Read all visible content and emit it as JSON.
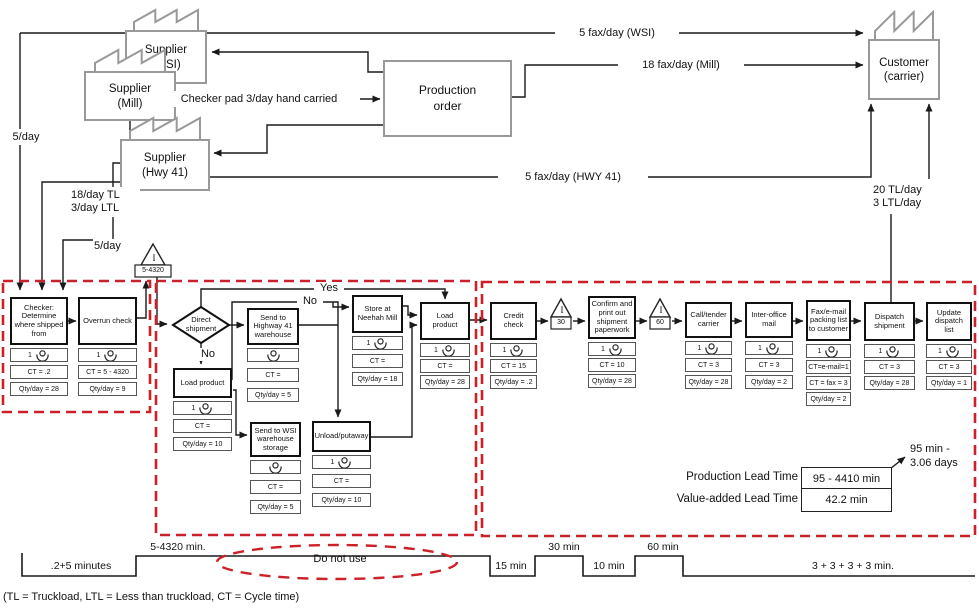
{
  "colors": {
    "line": "#1a1a1a",
    "factory_gray": "#999999",
    "dashed_red": "#cc2128"
  },
  "entities": {
    "supplier_wsi": "Supplier\n(WSI)",
    "supplier_mill": "Supplier\n(Mill)",
    "supplier_hwy41": "Supplier\n(Hwy 41)",
    "customer": "Customer\n(carrier)",
    "production_order": "Production\norder"
  },
  "decision": {
    "label": "Direct\nshipment"
  },
  "inventories": [
    {
      "id": "inv-main",
      "symbol": "I",
      "value": "5-4320"
    },
    {
      "id": "inv-30",
      "symbol": "I",
      "value": "30"
    },
    {
      "id": "inv-60",
      "symbol": "I",
      "value": "60"
    }
  ],
  "processes": [
    {
      "id": "checker",
      "title": "Checker:\nDetermine\nwhere shipped\nfrom",
      "operator": "1",
      "cells": [
        "CT = .2",
        "Qty/day = 28"
      ]
    },
    {
      "id": "overrun",
      "title": "Overrun check",
      "operator": "1",
      "cells": [
        "CT = 5 - 4320",
        "Qty/day = 9"
      ]
    },
    {
      "id": "load-product-no",
      "title": "Load product",
      "operator": "1",
      "cells": [
        "CT =",
        "Qty/day = 10"
      ]
    },
    {
      "id": "send-hwy41",
      "title": "Send to\nHighway 41\nwarehouse",
      "operator": "",
      "cells": [
        "CT =",
        "Qty/day = 5"
      ]
    },
    {
      "id": "store-mill",
      "title": "Store at\nNeehah Mill",
      "operator": "1",
      "cells": [
        "CT =",
        "Qty/day = 18"
      ]
    },
    {
      "id": "load-product",
      "title": "Load\nproduct",
      "operator": "1",
      "cells": [
        "CT =",
        "Qty/day = 28"
      ]
    },
    {
      "id": "send-wsi",
      "title": "Send to WSI\nwarehouse\nstorage",
      "operator": "",
      "cells": [
        "CT =",
        "Qty/day = 5"
      ]
    },
    {
      "id": "unload-putaway",
      "title": "Unload/putaway",
      "operator": "1",
      "cells": [
        "CT =",
        "Qty/day = 10"
      ]
    },
    {
      "id": "credit-check",
      "title": "Credit\ncheck",
      "operator": "1",
      "cells": [
        "CT = 15",
        "Qty/day = .2"
      ]
    },
    {
      "id": "confirm-paperwork",
      "title": "Confirm and\nprint out\nshipment\npaperwork",
      "operator": "1",
      "cells": [
        "CT = 10",
        "Qty/day = 28"
      ]
    },
    {
      "id": "call-tender",
      "title": "Call/tender\ncarrier",
      "operator": "1",
      "cells": [
        "CT = 3",
        "Qty/day = 28"
      ]
    },
    {
      "id": "inter-office",
      "title": "Inter-office\nmail",
      "operator": "1",
      "cells": [
        "CT = 3",
        "Qty/day = 2"
      ]
    },
    {
      "id": "fax-email",
      "title": "Fax/e-mail\npacking list\nto customer",
      "operator": "1",
      "cells": [
        "CT=e-mail=1",
        "CT = fax = 3",
        "Qty/day = 2"
      ]
    },
    {
      "id": "dispatch",
      "title": "Dispatch\nshipment",
      "operator": "1",
      "cells": [
        "CT = 3",
        "Qty/day = 28"
      ]
    },
    {
      "id": "update-list",
      "title": "Update\ndispatch\nlist",
      "operator": "1",
      "cells": [
        "CT = 3",
        "Qty/day = 1"
      ]
    }
  ],
  "flow_labels": [
    {
      "id": "fax-wsi",
      "text": "5 fax/day (WSI)"
    },
    {
      "id": "fax-mill",
      "text": "18 fax/day (Mill)"
    },
    {
      "id": "checker-pad",
      "text": "Checker pad 3/day hand carried"
    },
    {
      "id": "fax-hwy41",
      "text": "5 fax/day (HWY 41)"
    },
    {
      "id": "per-day-left",
      "text": "5/day"
    },
    {
      "id": "tl-ltl",
      "text": "18/day TL\n3/day LTL"
    },
    {
      "id": "per-day-hwy",
      "text": "5/day"
    },
    {
      "id": "tl-customer",
      "text": "20 TL/day\n3 LTL/day"
    },
    {
      "id": "yes",
      "text": "Yes"
    },
    {
      "id": "no-upper",
      "text": "No"
    },
    {
      "id": "no-lower",
      "text": "No"
    }
  ],
  "timeline": {
    "segments": [
      ".2+5 minutes",
      "5-4320 min.",
      "15 min",
      "30 min",
      "10 min",
      "60 min",
      "3 + 3 + 3 + 3 min."
    ],
    "do_not_use": "Do not use"
  },
  "lead_time": {
    "production_label": "Production Lead Time",
    "production_value": "95 - 4410 min",
    "value_added_label": "Value-added Lead Time",
    "value_added_value": "42.2 min",
    "callout": "95 min -\n3.06 days"
  },
  "footnote": "(TL = Truckload, LTL = Less than truckload, CT = Cycle time)"
}
